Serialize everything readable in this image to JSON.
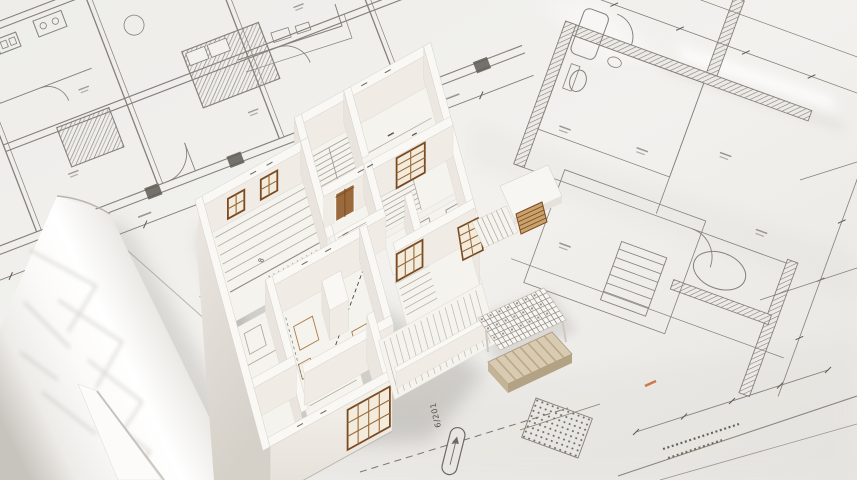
{
  "scene": {
    "description": "White architectural cutaway scale model of a house standing on flat and rolled blueprint floor-plan sheets",
    "subject": "architectural model photo",
    "colors": {
      "paper": "#f0eeea",
      "paper_dark": "#e3e1dd",
      "line": "#85817a",
      "line_dark": "#5e5a54",
      "model_white": "#f9f7f3",
      "wall_top": "#faf8f4",
      "wall_face_s": "#f0ece5",
      "wall_face_w": "#e9e5de",
      "wall_ext_hi": "#efebe4",
      "wall_ext_lo": "#d6d1c9",
      "floor": "#f5f3ee",
      "plank": "#b6b1a8",
      "stair": "#a7a29a",
      "wood": "#9a6a3c",
      "wood_dark": "#7a4a22",
      "wood_light": "#c9a36b",
      "glass": "#f3ecdc",
      "beige": "#d9cbb2",
      "beige_dark": "#b3a284",
      "sepia": "#ad7a4a",
      "shadow": "#76716a",
      "orange": "#c96f3a",
      "edge": "#d6d2ca"
    }
  },
  "annotations": [
    {
      "id": "a1",
      "text": "6/201"
    },
    {
      "id": "a2",
      "text": "8"
    }
  ]
}
